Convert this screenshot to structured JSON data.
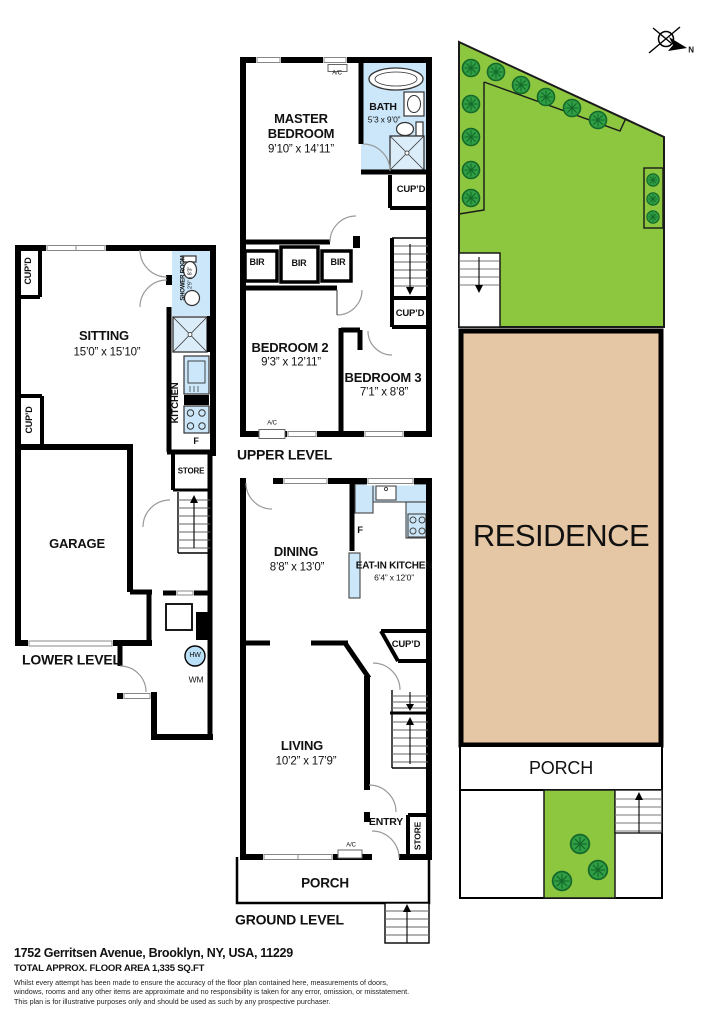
{
  "labels": {
    "lower": {
      "title": "LOWER LEVEL",
      "cupd_top": "CUP’D",
      "cupd_bottom": "CUP’D",
      "sitting_name": "SITTING",
      "sitting_dims": "15’0” x 15’10”",
      "shower_name": "SHOWER ROOM",
      "shower_dims": "2’9” x 8’3”",
      "kitchen": "KITCHEN",
      "fridge": "F",
      "garage": "GARAGE",
      "store": "STORE",
      "hw": "HW",
      "wm": "WM"
    },
    "upper": {
      "title": "UPPER LEVEL",
      "ac_top": "A/C",
      "master_line1": "MASTER",
      "master_line2": "BEDROOM",
      "master_dims": "9’10” x 14’11”",
      "bath_name": "BATH",
      "bath_dims": "5’3 x 9’0”",
      "cupd_bath": "CUP’D",
      "bir1": "BIR",
      "bir2": "BIR",
      "bir3": "BIR",
      "cupd_landing": "CUP’D",
      "bed2_name": "BEDROOM 2",
      "bed2_dims": "9’3” x 12’11”",
      "bed3_name": "BEDROOM 3",
      "bed3_dims": "7’1” x 8’8”",
      "ac_bottom": "A/C"
    },
    "ground": {
      "title": "GROUND LEVEL",
      "dining_name": "DINING",
      "dining_dims": "8’8” x 13’0”",
      "fridge": "F",
      "eatin_name": "EAT-IN KITCHEN",
      "eatin_dims": "6’4” x 12’0”",
      "cupd": "CUP’D",
      "living_name": "LIVING",
      "living_dims": "10’2” x 17’9”",
      "entry": "ENTRY",
      "store": "STORE",
      "ac": "A/C",
      "porch": "PORCH"
    },
    "site": {
      "residence": "RESIDENCE",
      "porch": "PORCH",
      "north": "N"
    },
    "footer": {
      "address": "1752 Gerritsen Avenue, Brooklyn, NY, USA, 11229",
      "area": "TOTAL APPROX. FLOOR AREA 1,335 SQ.FT",
      "disclaimer1": "Whilst every attempt has been made to ensure the accuracy of the floor plan contained here, measurements of doors,",
      "disclaimer2": "windows, rooms and any other items are approximate and no responsibility is taken for any error, omission, or misstatement.",
      "disclaimer3": "This plan is for illustrative purposes only and should be used as such by any prospective purchaser."
    }
  },
  "colors": {
    "wall": "#000000",
    "wet_area": "#cbe7f9",
    "garden_green": "#8dc63f",
    "tree_green": "#2f9e44",
    "residence_tan": "#e6c7a5"
  }
}
